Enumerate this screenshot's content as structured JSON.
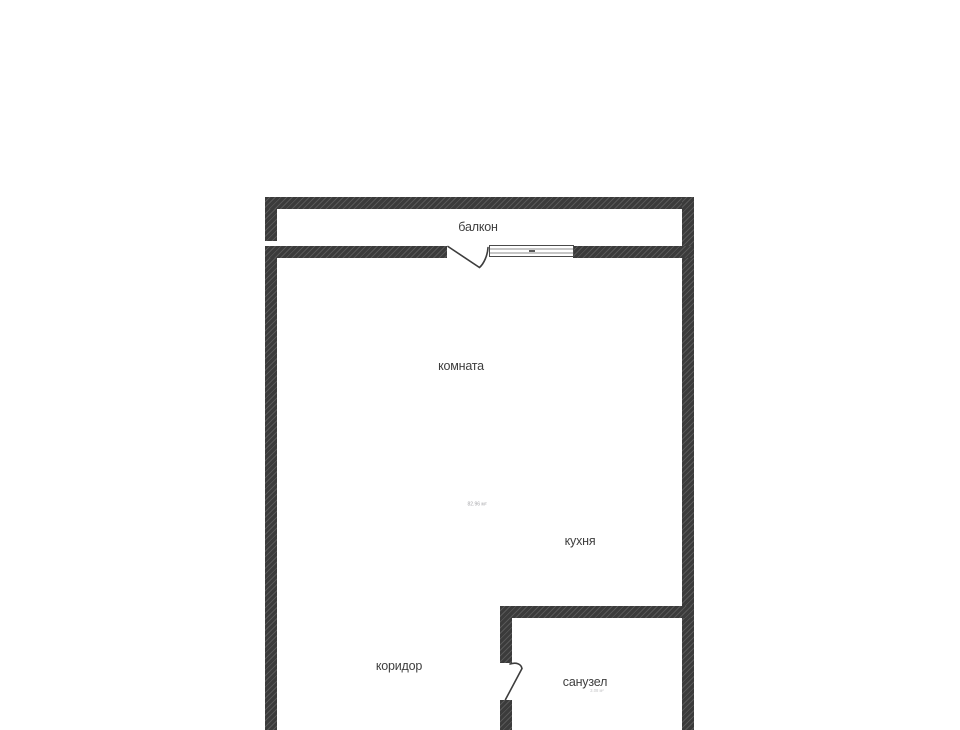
{
  "plan": {
    "rooms": [
      {
        "id": "balcony",
        "label": "балкон"
      },
      {
        "id": "room",
        "label": "комната"
      },
      {
        "id": "kitchen",
        "label": "кухня"
      },
      {
        "id": "corridor",
        "label": "коридор"
      },
      {
        "id": "bathroom",
        "label": "санузел"
      }
    ],
    "annotations": {
      "main_area": "82.96 м²",
      "bathroom_area": "3.08 м²"
    },
    "colors": {
      "wall_base": "#3b3b3b",
      "wall_hatch": "#585858",
      "background": "#ffffff",
      "label_text": "#3e3e3e",
      "faint_text": "#a6a6aa"
    }
  }
}
